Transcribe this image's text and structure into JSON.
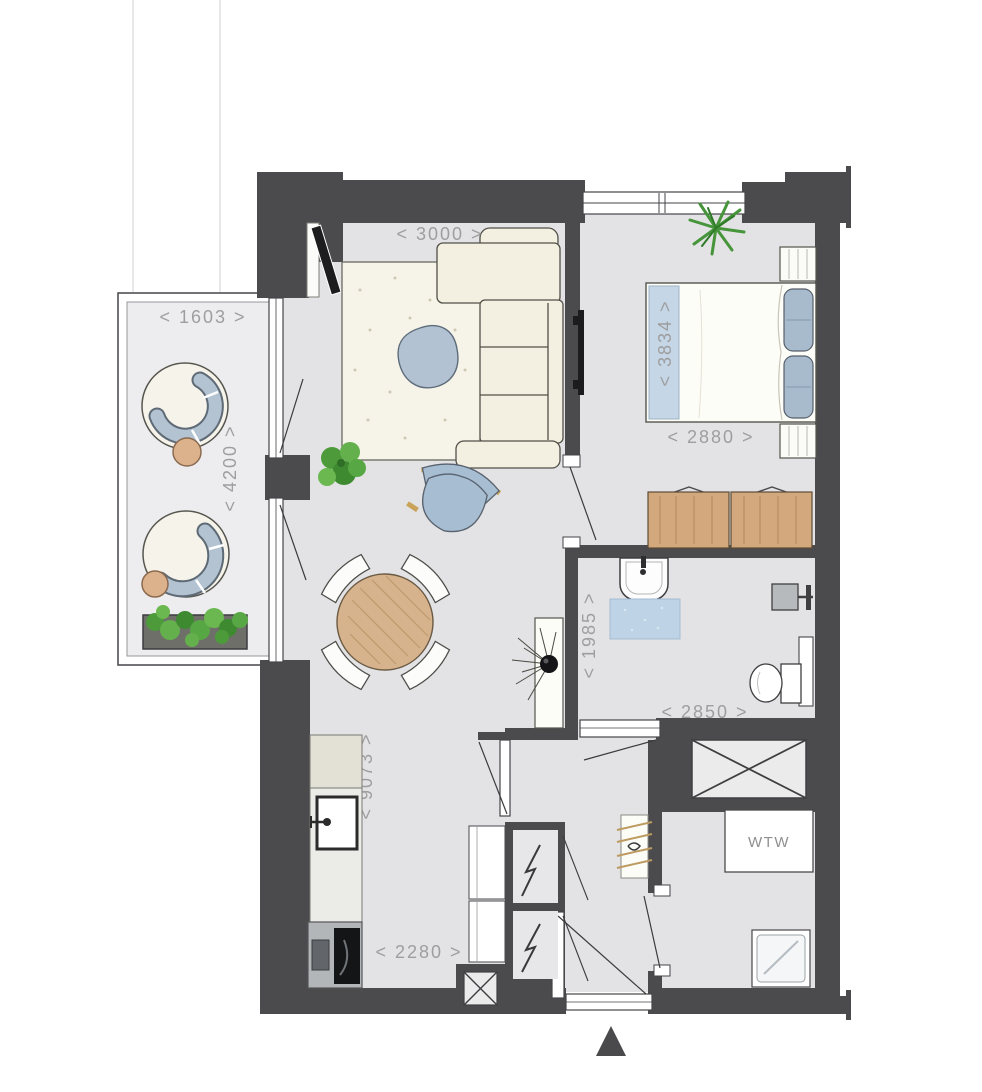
{
  "floorplan": {
    "type": "apartment-floor-plan",
    "labels": {
      "ventilation_unit": "WTW"
    },
    "dimensions": {
      "living_width": "< 3000 >",
      "balcony_width": "< 1603 >",
      "balcony_depth": "< 4200 >",
      "bed_length": "< 3834 >",
      "bedroom_width": "< 2880 >",
      "bathroom_depth": "< 1985 >",
      "bathroom_width": "< 2850 >",
      "apartment_depth": "< 9073 >",
      "kitchen_width": "< 2280 >"
    },
    "colors": {
      "wall": "#4b4b4d",
      "floor": "#e3e3e5",
      "balcony_floor": "#ededef",
      "dimension_text": "#9e9e9e",
      "accent_blue": "#b3c2d2",
      "wood": "#d2a87c",
      "cream": "#f4f0e1",
      "plant_green": "#4f9e3c"
    }
  }
}
